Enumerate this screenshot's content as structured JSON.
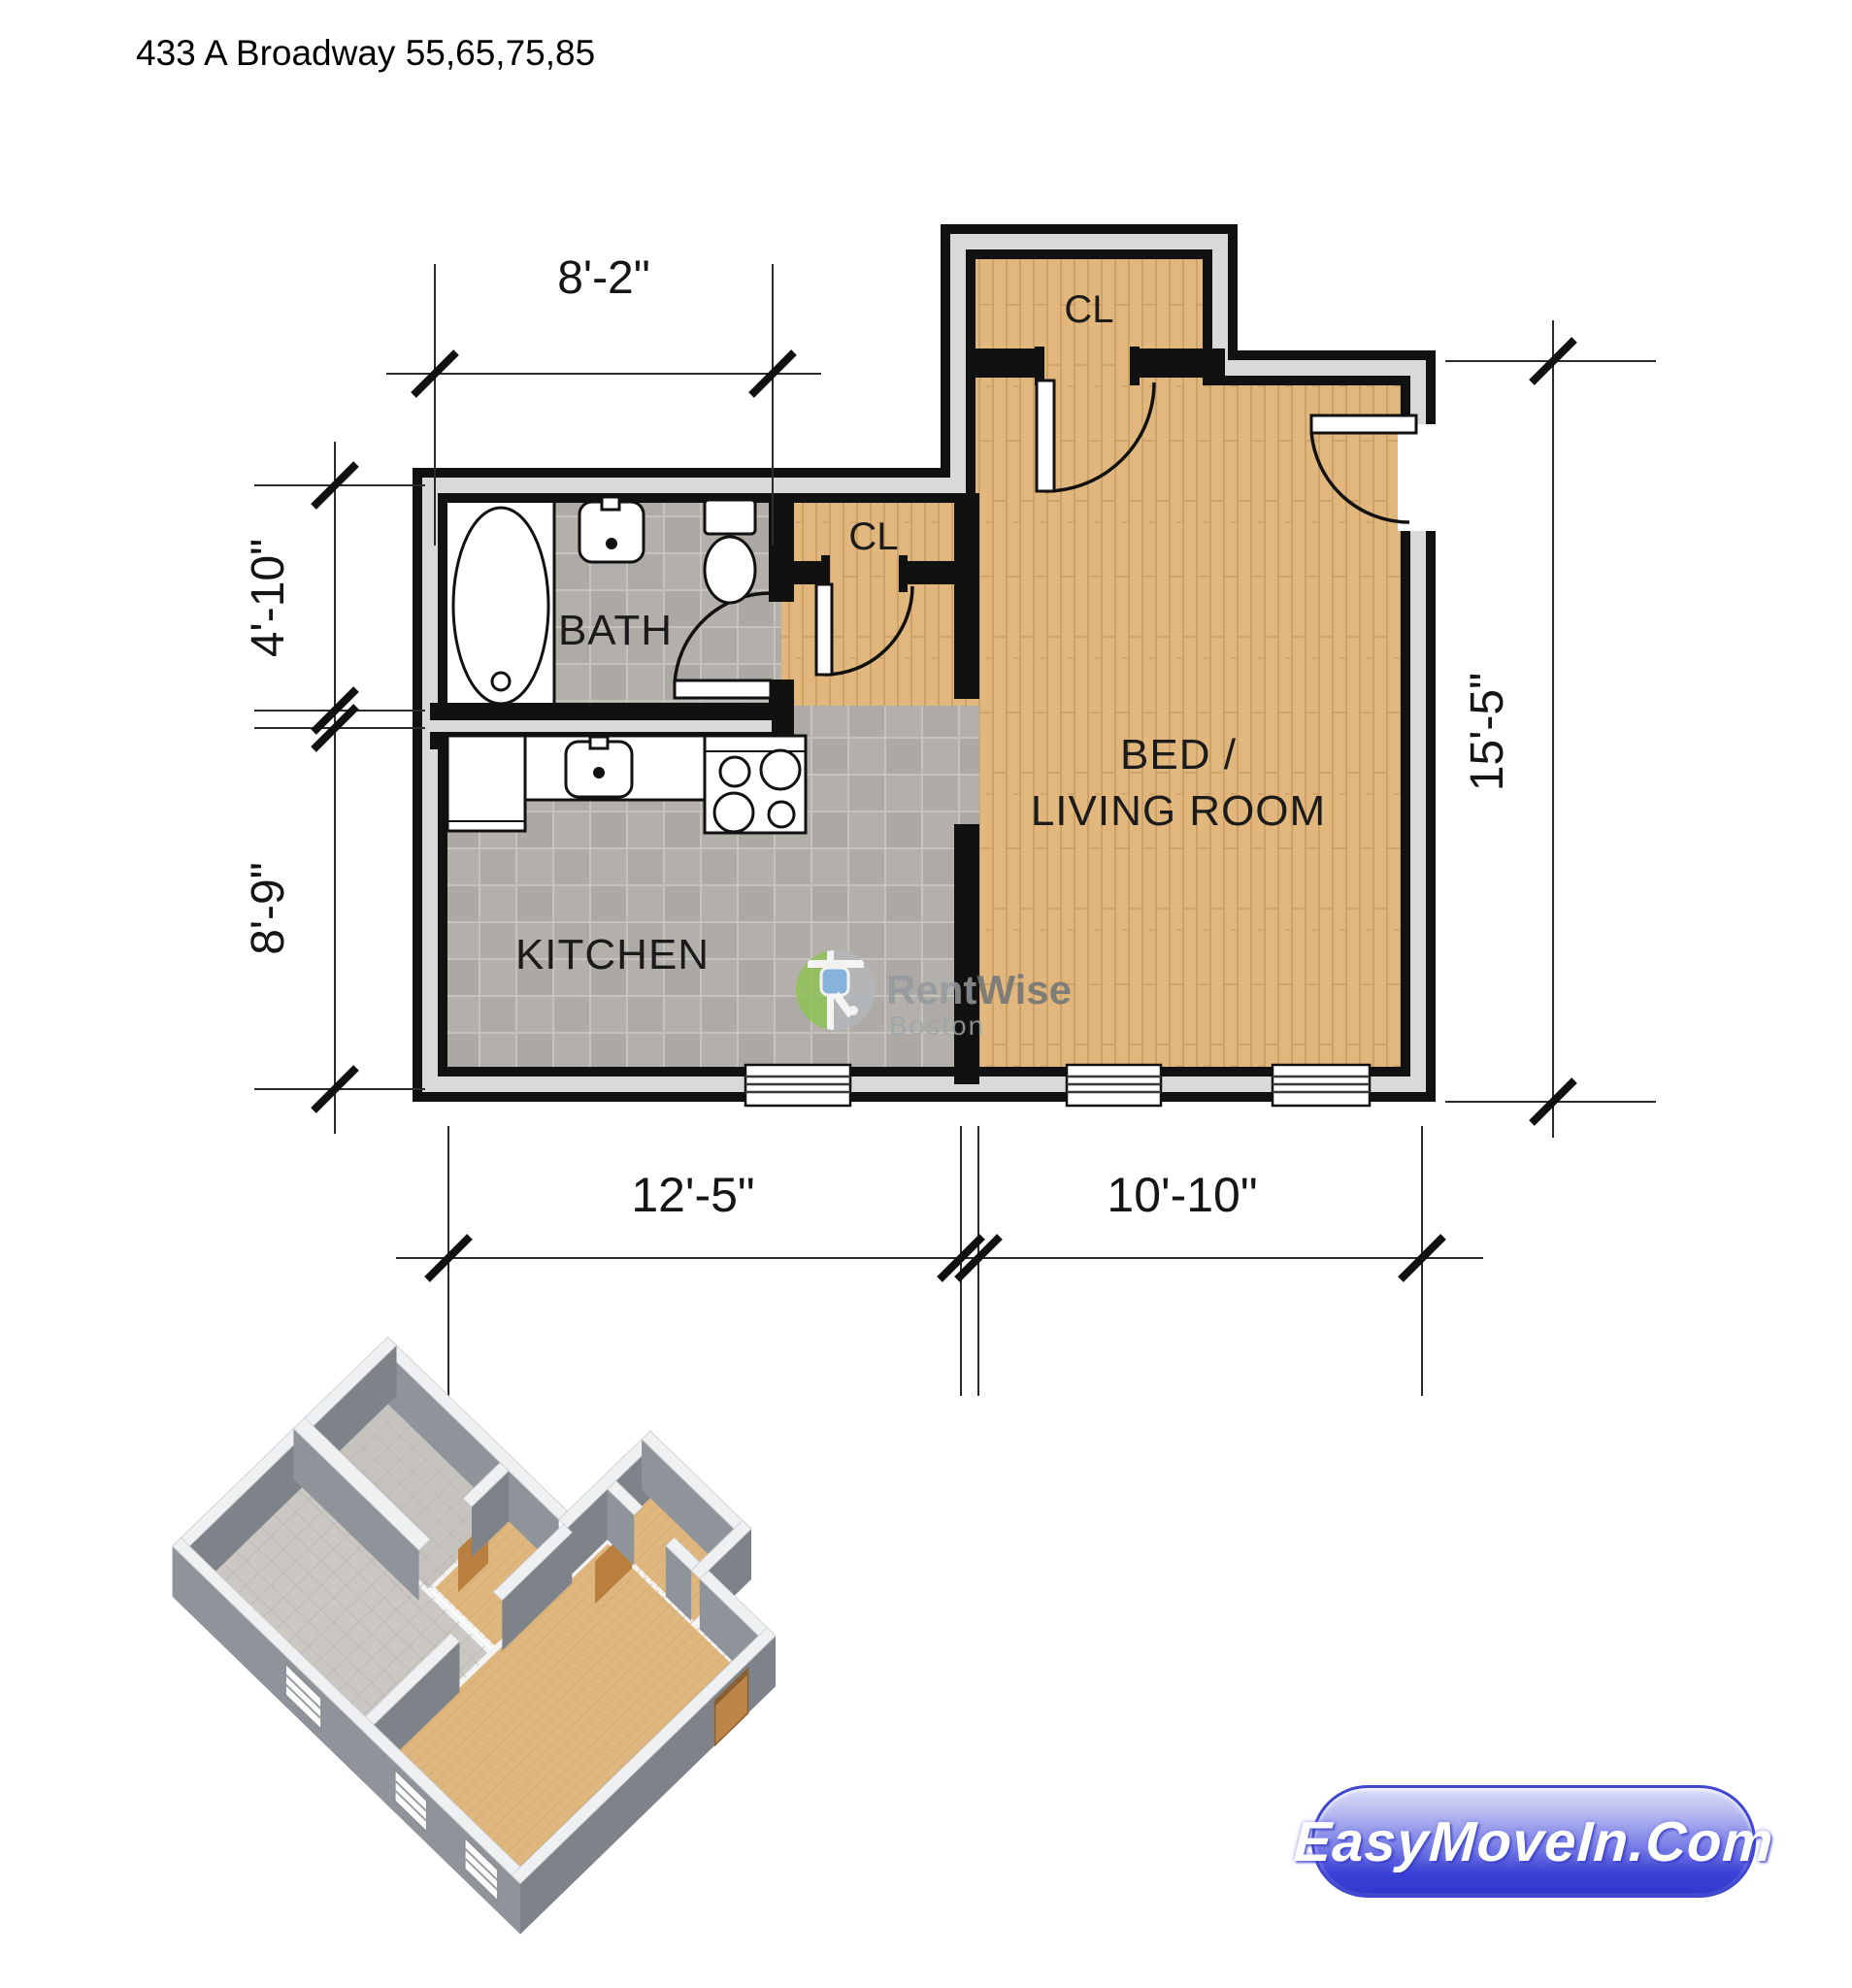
{
  "page": {
    "title": "433 A Broadway 55,65,75,85"
  },
  "floor_plan": {
    "rooms": {
      "closet_top": {
        "label": "CL"
      },
      "closet_mid": {
        "label": "CL"
      },
      "bath": {
        "label": "BATH"
      },
      "kitchen": {
        "label": "KITCHEN"
      },
      "bed_living": {
        "line1": "BED /",
        "line2": "LIVING ROOM"
      }
    },
    "dimensions": {
      "top": "8'-2\"",
      "left_upper": "4'-10\"",
      "left_lower": "8'-9\"",
      "right": "15'-5\"",
      "bottom_left": "12'-5\"",
      "bottom_right": "10'-10\""
    },
    "colors": {
      "wood_floor": "#e2b77d",
      "wood_line": "#c79c62",
      "tile_floor": "#b3afab",
      "wall": "#111111",
      "wall_liner": "#d9d9d9",
      "iso_wall_front": "#8f949b",
      "iso_wall_side": "#7e838a",
      "iso_wall_top": "#eef0f2",
      "iso_wood": "#dfb67e",
      "iso_tile": "#cbc8c3",
      "iso_door_wood": "#bd8648"
    }
  },
  "watermark": {
    "brand_first": "Rent",
    "brand_second": "Wise",
    "city": "Boston"
  },
  "badge": {
    "label": "EasyMoveIn.Com"
  }
}
